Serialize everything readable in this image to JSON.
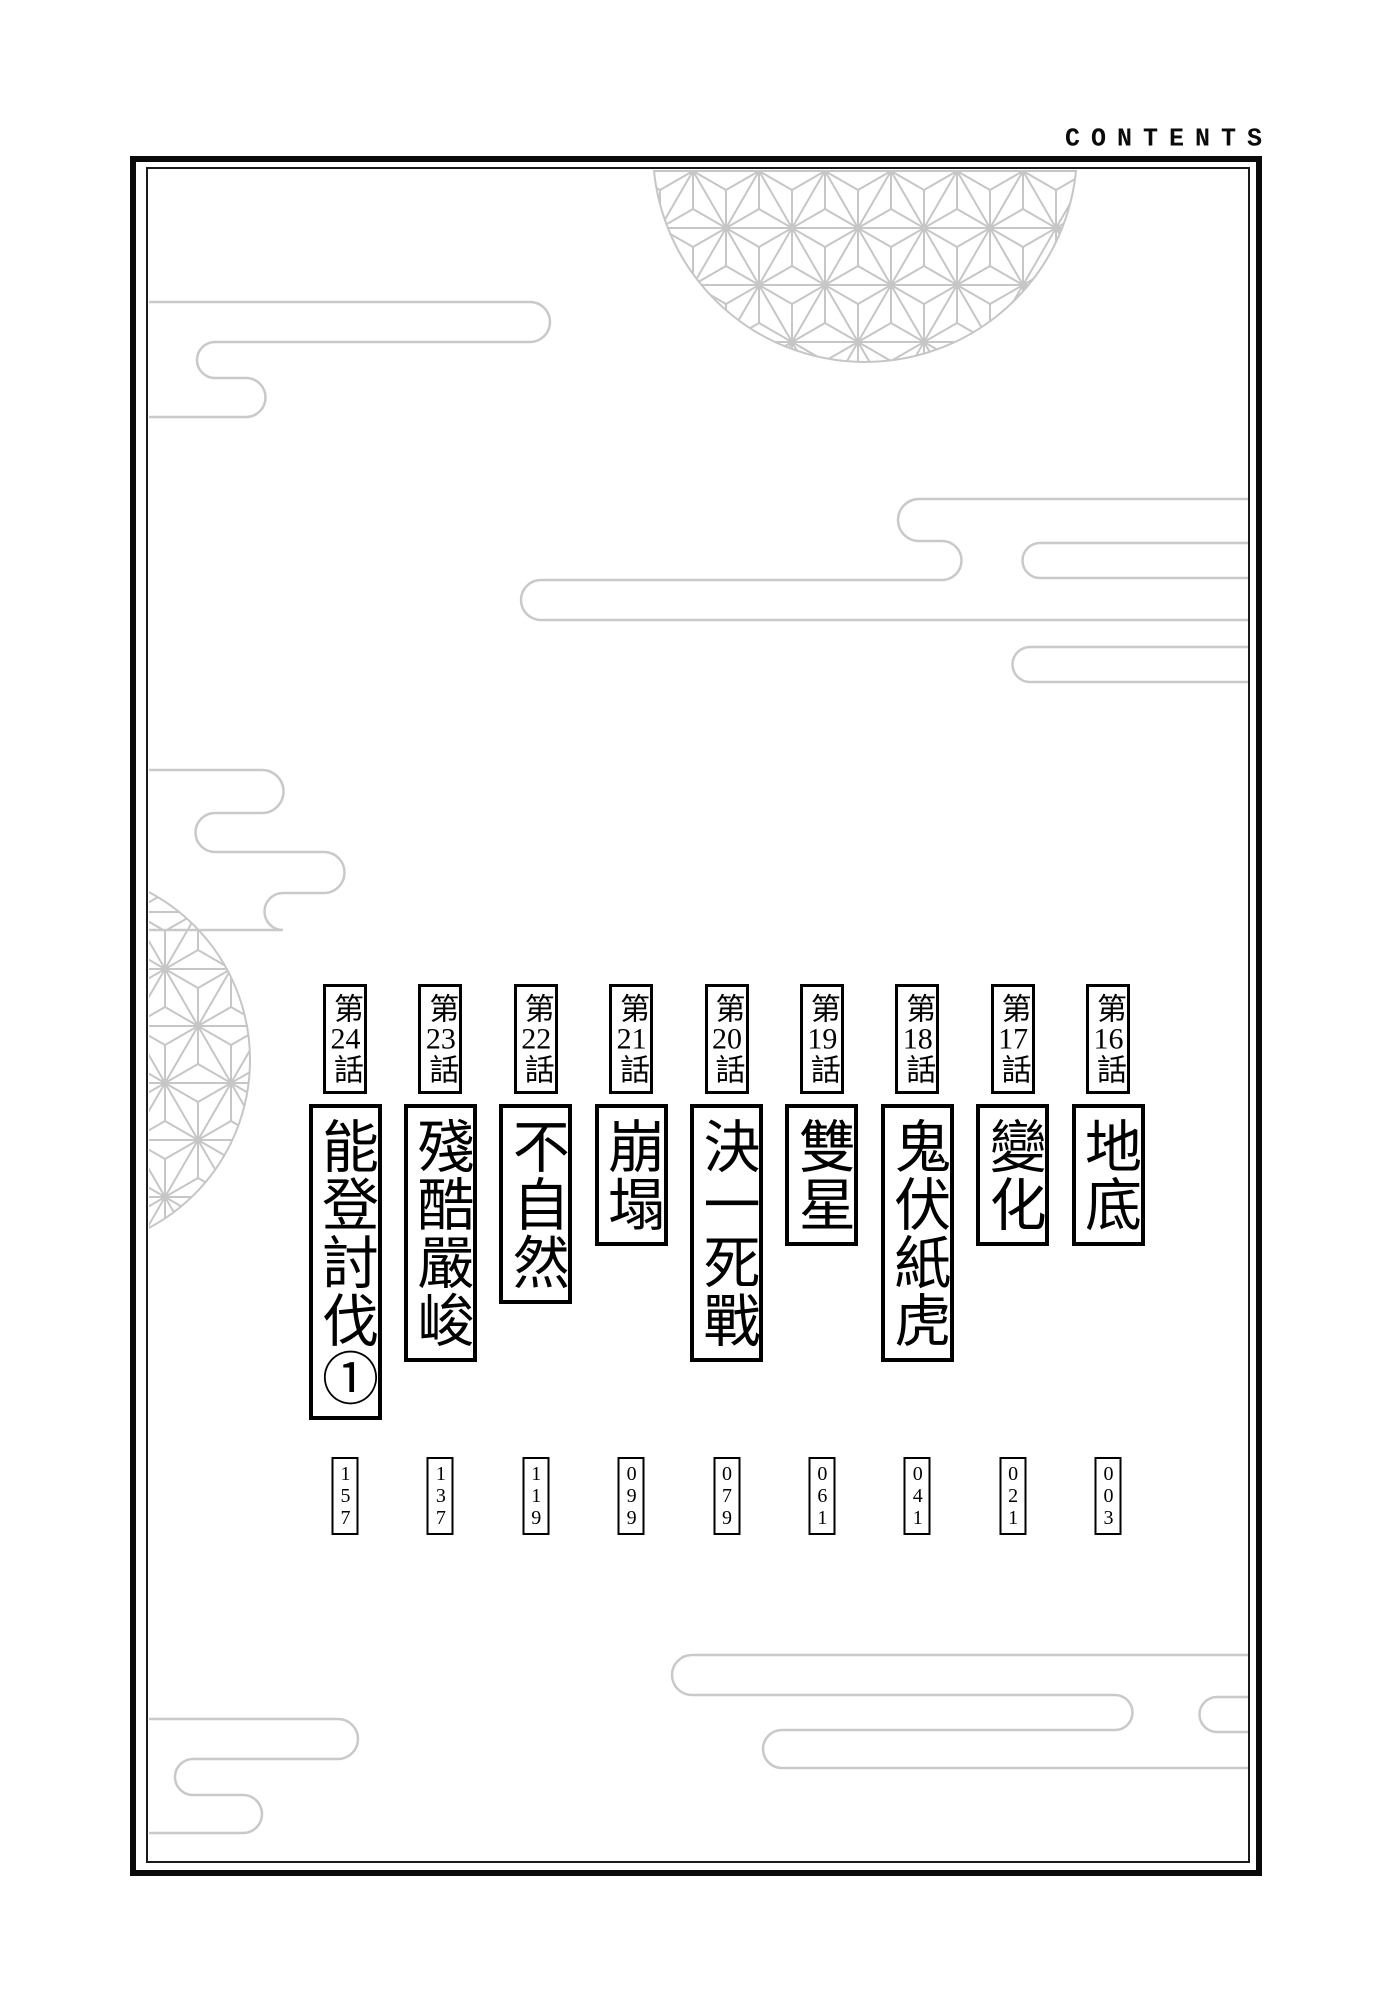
{
  "header": {
    "contents_label": "CONTENTS"
  },
  "chapters": [
    {
      "number_prefix": "第",
      "number": "16",
      "number_suffix": "話",
      "title": "地底",
      "page": "003"
    },
    {
      "number_prefix": "第",
      "number": "17",
      "number_suffix": "話",
      "title": "變化",
      "page": "021"
    },
    {
      "number_prefix": "第",
      "number": "18",
      "number_suffix": "話",
      "title": "鬼伏紙虎",
      "page": "041"
    },
    {
      "number_prefix": "第",
      "number": "19",
      "number_suffix": "話",
      "title": "雙星",
      "page": "061"
    },
    {
      "number_prefix": "第",
      "number": "20",
      "number_suffix": "話",
      "title": "決一死戰",
      "page": "079"
    },
    {
      "number_prefix": "第",
      "number": "21",
      "number_suffix": "話",
      "title": "崩塌",
      "page": "099"
    },
    {
      "number_prefix": "第",
      "number": "22",
      "number_suffix": "話",
      "title": "不自然",
      "page": "119"
    },
    {
      "number_prefix": "第",
      "number": "23",
      "number_suffix": "話",
      "title": "殘酷嚴峻",
      "page": "137"
    },
    {
      "number_prefix": "第",
      "number": "24",
      "number_suffix": "話",
      "title": "能登討伐①",
      "page": "157"
    }
  ],
  "decor": {
    "pattern_name": "asanoha-hemp-leaf",
    "pattern_color": "#c6c6c6",
    "cloud_color": "#c9c9c9",
    "frame_color": "#0a0a0a",
    "background_color": "#ffffff"
  }
}
